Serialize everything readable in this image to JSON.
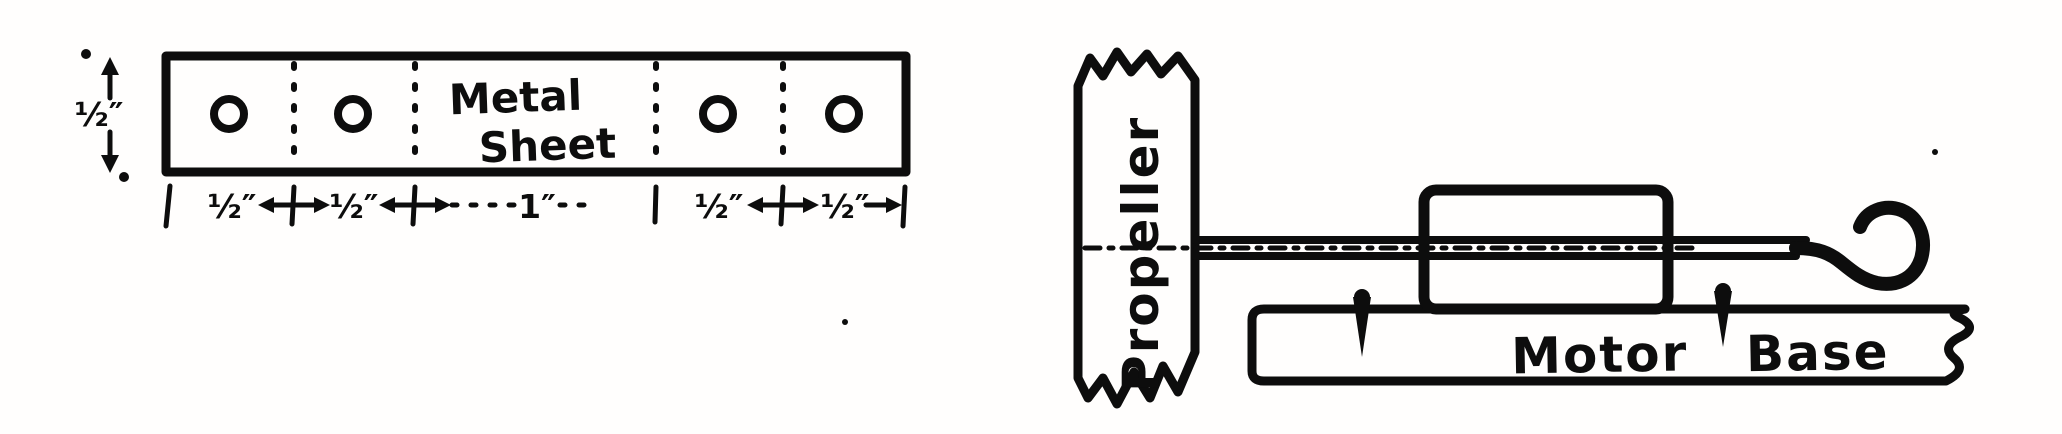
{
  "figure": {
    "kind": "scanned technical drawing, hand lettered ink on white paper",
    "ink_color": "#0d0d0d",
    "paper_color": "#fffefd",
    "left_panel": {
      "label_line1": "Metal",
      "label_line2": "Sheet",
      "width_dimension": "½″",
      "bottom_dimensions": [
        "½″",
        "½″",
        "1″",
        "½″",
        "½″"
      ],
      "hole_count": 4,
      "fold_line_count": 4
    },
    "right_panel": {
      "propeller_label": "Propeller",
      "base_label_word1": "Motor",
      "base_label_word2": "Base"
    }
  }
}
